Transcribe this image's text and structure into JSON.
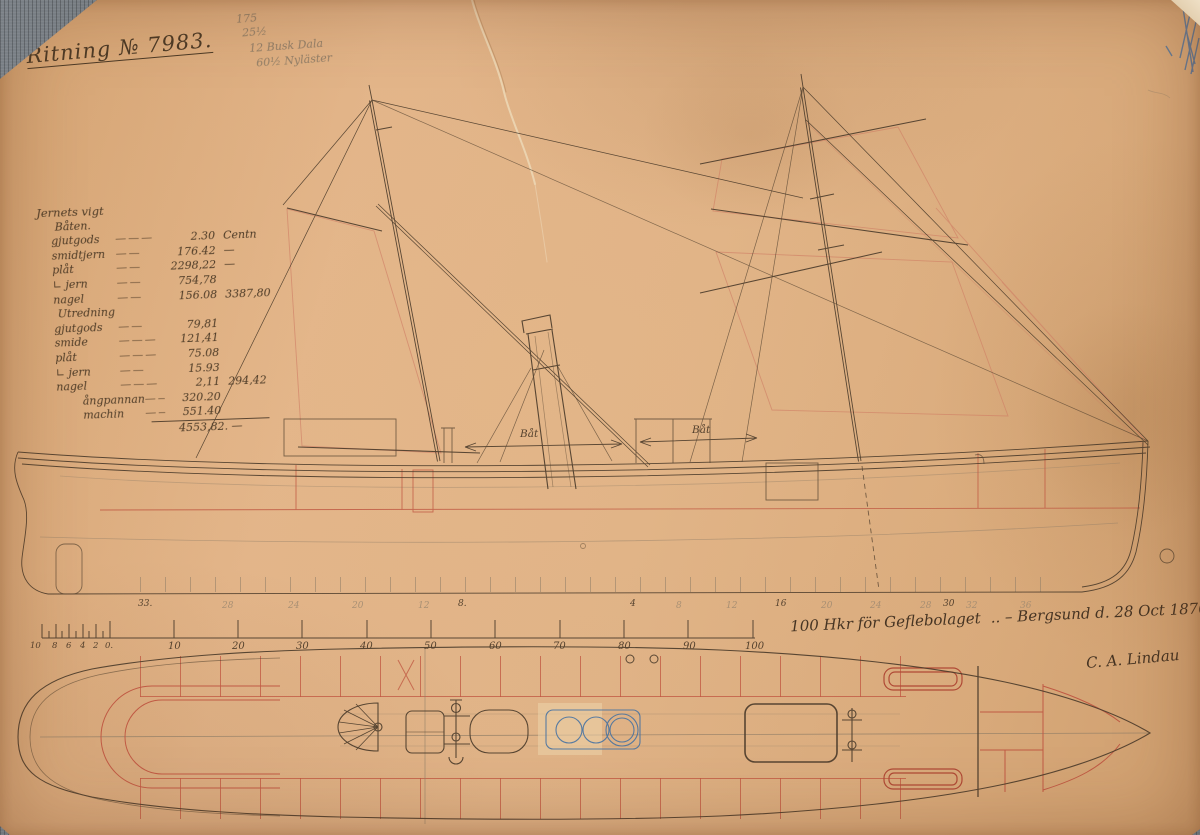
{
  "drawing": {
    "title": "Ritning № 7983.",
    "pencil_notes": [
      {
        "label": "175",
        "x": 2,
        "y": 0
      },
      {
        "label": "25½",
        "x": 7,
        "y": 14
      },
      {
        "label": "12 Busk Dala",
        "x": 13,
        "y": 30
      },
      {
        "label": "60½ Nyläster",
        "x": 19,
        "y": 45
      }
    ],
    "inscription": {
      "dedication": "100 Hkr för Geflebolaget",
      "place_date": ".. – Bergsund d. 28 Oct 1870 –",
      "signature": "C. A. Lindau"
    },
    "boat_labels": [
      {
        "label": "Båt",
        "x": 520,
        "y": 428
      },
      {
        "label": "Båt",
        "x": 692,
        "y": 424
      }
    ]
  },
  "weight_table": {
    "heading": "Jernets vigt",
    "section1": "Båten.",
    "rows1": [
      {
        "label": "gjutgods",
        "dash": "———",
        "value": "2.30",
        "extra": "Centn"
      },
      {
        "label": "smidtjern",
        "dash": "——",
        "value": "176.42",
        "extra": "—"
      },
      {
        "label": "plåt",
        "dash": "——",
        "value": "2298,22",
        "extra": "—"
      },
      {
        "label": "∟ jern",
        "dash": "——",
        "value": "754,78",
        "extra": ""
      },
      {
        "label": "nagel",
        "dash": "——",
        "value": "156.08",
        "extra": "3387,80"
      }
    ],
    "section2": "Utredning",
    "rows2": [
      {
        "label": "gjutgods",
        "dash": "——",
        "value": "79,81",
        "extra": ""
      },
      {
        "label": "smide",
        "dash": "———",
        "value": "121,41",
        "extra": ""
      },
      {
        "label": "plåt",
        "dash": "———",
        "value": "75.08",
        "extra": ""
      },
      {
        "label": "∟ jern",
        "dash": "——",
        "value": "15.93",
        "extra": ""
      },
      {
        "label": "nagel",
        "dash": "———",
        "value": "2,11",
        "extra": "294,42"
      },
      {
        "label": "ångpannan",
        "dash": "——",
        "value": "320.20",
        "extra": "",
        "cls": "indent"
      },
      {
        "label": "machin",
        "dash": "——",
        "value": "551.40",
        "extra": "",
        "cls": "indent"
      }
    ],
    "total": "4553,82. —"
  },
  "stations": [
    {
      "label": "33.",
      "x": 138,
      "cls": "ink"
    },
    {
      "label": "28",
      "x": 222,
      "cls": "pencilc"
    },
    {
      "label": "24",
      "x": 288,
      "cls": "pencilc"
    },
    {
      "label": "20",
      "x": 352,
      "cls": "pencilc"
    },
    {
      "label": "12",
      "x": 418,
      "cls": "pencilc"
    },
    {
      "label": "8.",
      "x": 458,
      "cls": "ink"
    },
    {
      "label": "4",
      "x": 630,
      "cls": "ink"
    },
    {
      "label": "8",
      "x": 676,
      "cls": "pencilc"
    },
    {
      "label": "12",
      "x": 726,
      "cls": "pencilc"
    },
    {
      "label": "16",
      "x": 775,
      "cls": "ink"
    },
    {
      "label": "20",
      "x": 821,
      "cls": "pencilc"
    },
    {
      "label": "24",
      "x": 870,
      "cls": "pencilc"
    },
    {
      "label": "28",
      "x": 920,
      "cls": "pencilc"
    },
    {
      "label": "30",
      "x": 943,
      "cls": "ink"
    },
    {
      "label": "32",
      "x": 966,
      "cls": "pencilc"
    },
    {
      "label": "36",
      "x": 1020,
      "cls": "pencilc"
    }
  ],
  "scale_bar": {
    "minor": [
      {
        "label": "10",
        "x": 30
      },
      {
        "label": "8",
        "x": 52
      },
      {
        "label": "6",
        "x": 66
      },
      {
        "label": "4",
        "x": 80
      },
      {
        "label": "2",
        "x": 93
      },
      {
        "label": "0.",
        "x": 105
      }
    ],
    "major": [
      {
        "label": "10",
        "x": 168
      },
      {
        "label": "20",
        "x": 232
      },
      {
        "label": "30",
        "x": 296
      },
      {
        "label": "40",
        "x": 360
      },
      {
        "label": "50",
        "x": 424
      },
      {
        "label": "60",
        "x": 489
      },
      {
        "label": "70",
        "x": 553
      },
      {
        "label": "80",
        "x": 618
      },
      {
        "label": "90",
        "x": 683
      },
      {
        "label": "100",
        "x": 745
      }
    ]
  },
  "colors": {
    "paper": "#dfb184",
    "ink": "#4d3d2c",
    "red": "#c05a44",
    "pencil": "#8f7d67",
    "blue": "#3f6fa3",
    "backdrop": "#686d72"
  }
}
